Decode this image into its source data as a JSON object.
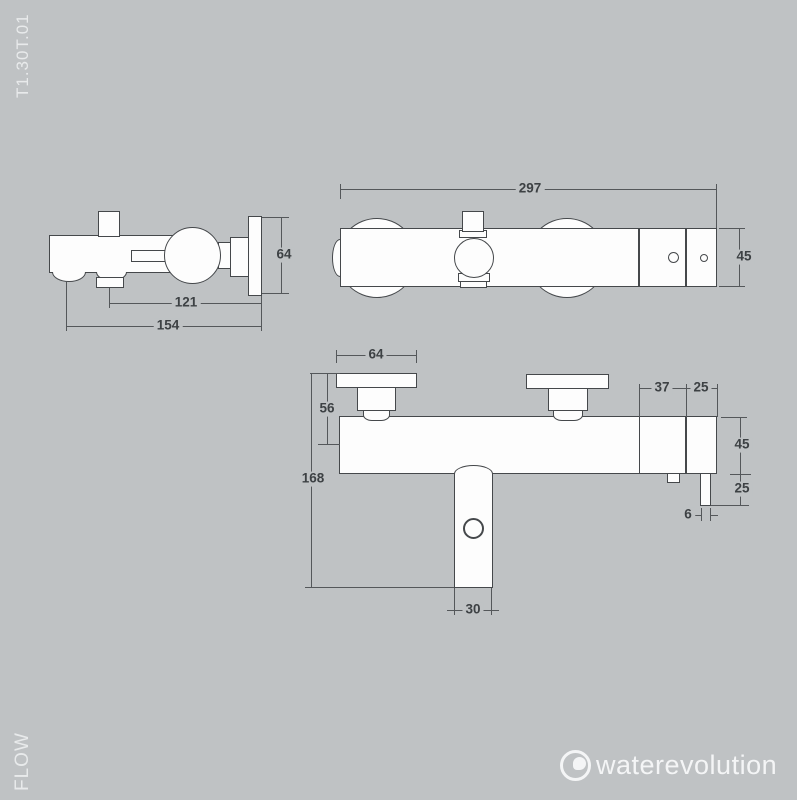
{
  "page": {
    "background_color": "#bfc2c4",
    "drawing_line_color": "#45484b",
    "dimension_text_color": "#3d4144"
  },
  "labels": {
    "product_code": "T1.30T.01",
    "flow": "FLOW",
    "brand": "waterevolution"
  },
  "views": {
    "side": {
      "title": "side view (wall-mounted bath mixer, profile)",
      "dims": {
        "plate_height_64": "64",
        "hose_offset_121": "121",
        "total_depth_154": "154"
      }
    },
    "top": {
      "title": "top view",
      "dims": {
        "total_width_297": "297",
        "body_depth_45": "45"
      }
    },
    "front": {
      "title": "front view",
      "dims": {
        "plate_width_64": "64",
        "plate_to_axis_56": "56",
        "total_height_168": "168",
        "spout_width_30": "30",
        "offset_37": "37",
        "offset_25": "25",
        "body_height_45": "45",
        "outlet_drop_25": "25",
        "outlet_width_6": "6"
      }
    }
  }
}
